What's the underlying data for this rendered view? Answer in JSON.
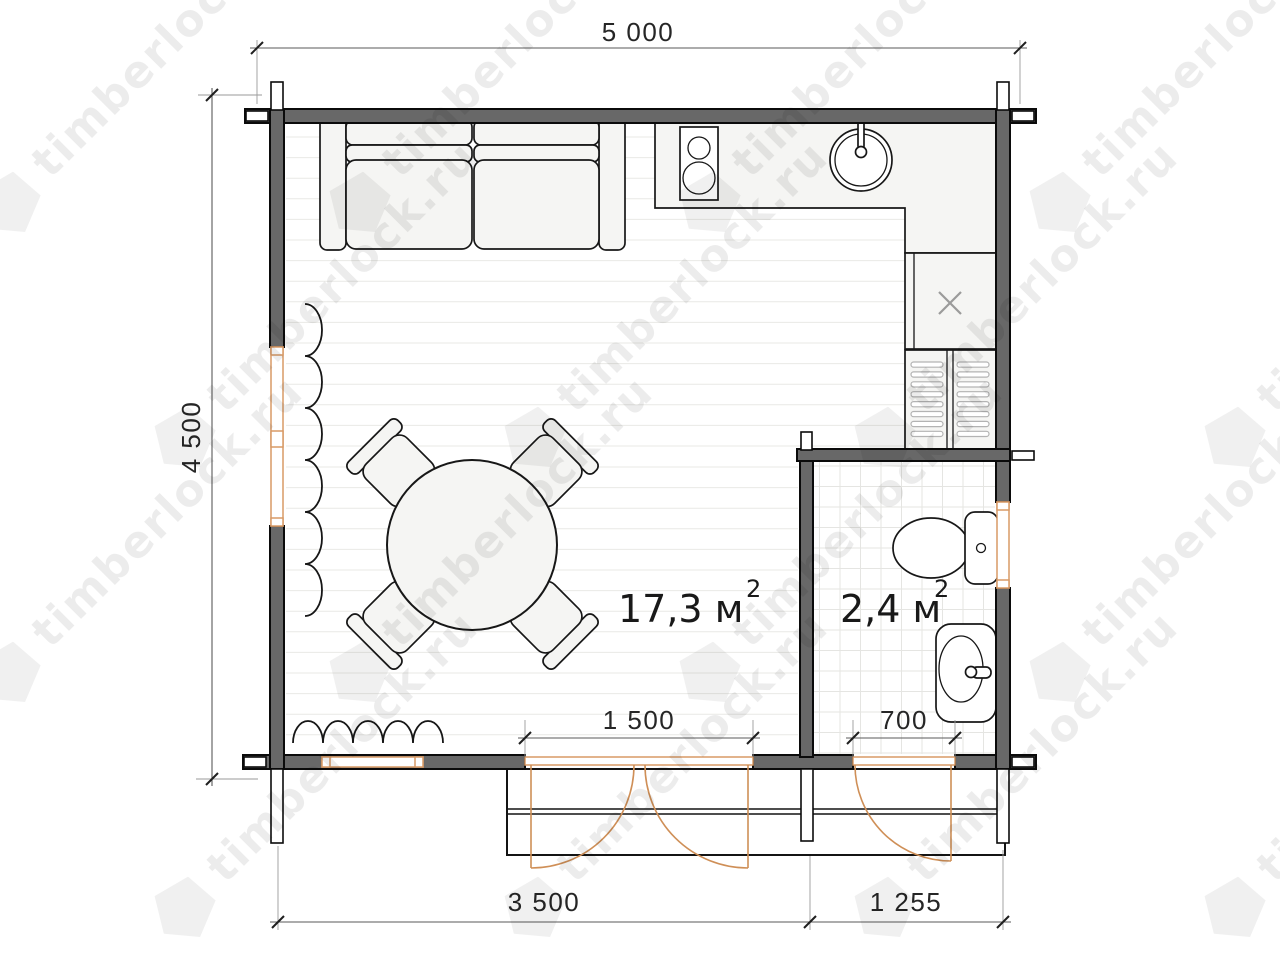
{
  "watermark": {
    "text": "timberlock.ru"
  },
  "dimensions": {
    "width_total": "5 000",
    "height_total": "4 500",
    "door_main_opening": "1 500",
    "door_bath_opening": "700",
    "bottom_main": "3 500",
    "bottom_bath": "1 255"
  },
  "rooms": {
    "main": {
      "area": "17,3 м",
      "sup": "2"
    },
    "bath": {
      "area": "2,4 м",
      "sup": "2"
    }
  },
  "colors": {
    "wall": "#686868",
    "wood_accent": "#cf8f57",
    "window_frame": "#d89a66",
    "floor_line": "#e9e9e6",
    "tile_line": "#e5e5e2",
    "watermark_text": "rgba(0,0,0,0.075)",
    "watermark_logo": "rgba(0,0,0,0.06)"
  }
}
